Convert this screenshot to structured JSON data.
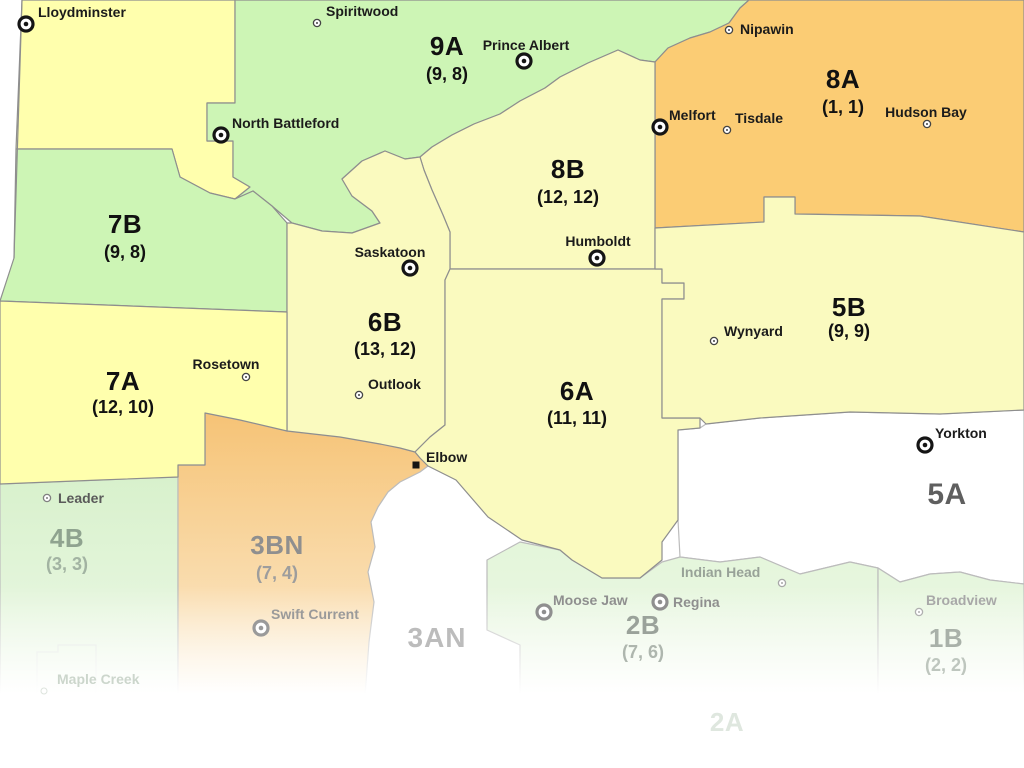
{
  "map": {
    "type": "region-map",
    "province": "Saskatchewan crop districts",
    "colors": {
      "green": "#cdf5b5",
      "yellow": "#ffffad",
      "pale_yellow": "#fafabf",
      "orange": "#fbcc74",
      "white": "#ffffff",
      "border": "#8e8e8e",
      "border_light": "#bcbcbc",
      "maple_outline": "#dbe2db"
    },
    "gradients": {
      "3BN": {
        "from": "#f6c478",
        "to": "#fbe7c6"
      },
      "4B": {
        "from": "#d8f1cc",
        "to": "#ecf8e6"
      },
      "SOUTH": {
        "from": "#e2f5d8",
        "to": "#eef8e8"
      }
    },
    "regions": [
      {
        "id": "9A",
        "label": "9A",
        "value": "(9, 8)",
        "fill": "green",
        "lx": 447,
        "ly": 46,
        "vy": 74,
        "label_color": "#111111",
        "value_color": "#111111"
      },
      {
        "id": "8A",
        "label": "8A",
        "value": "(1, 1)",
        "fill": "orange",
        "lx": 843,
        "ly": 79,
        "vy": 107,
        "label_color": "#111111",
        "value_color": "#111111"
      },
      {
        "id": "8B",
        "label": "8B",
        "value": "(12, 12)",
        "fill": "pale_yellow",
        "lx": 568,
        "ly": 169,
        "vy": 197,
        "label_color": "#111111",
        "value_color": "#111111"
      },
      {
        "id": "7B",
        "label": "7B",
        "value": "(9, 8)",
        "fill": "green",
        "lx": 125,
        "ly": 224,
        "vy": 252,
        "label_color": "#111111",
        "value_color": "#111111"
      },
      {
        "id": "7A",
        "label": "7A",
        "value": "(12, 10)",
        "fill": "yellow",
        "lx": 123,
        "ly": 381,
        "vy": 407,
        "label_color": "#111111",
        "value_color": "#111111"
      },
      {
        "id": "6B",
        "label": "6B",
        "value": "(13, 12)",
        "fill": "pale_yellow",
        "lx": 385,
        "ly": 322,
        "vy": 349,
        "label_color": "#111111",
        "value_color": "#111111"
      },
      {
        "id": "6A",
        "label": "6A",
        "value": "(11, 11)",
        "fill": "pale_yellow",
        "lx": 577,
        "ly": 391,
        "vy": 418,
        "label_color": "#111111",
        "value_color": "#111111"
      },
      {
        "id": "5B",
        "label": "5B",
        "value": "(9, 9)",
        "fill": "pale_yellow",
        "lx": 849,
        "ly": 307,
        "vy": 331,
        "label_color": "#111111",
        "value_color": "#111111"
      },
      {
        "id": "5A",
        "label": "5A",
        "value": null,
        "fill": "white",
        "lx": 947,
        "ly": 495,
        "size": "big",
        "label_color": "#5f5f5f"
      },
      {
        "id": "4B",
        "label": "4B",
        "value": "(3, 3)",
        "fill": "grad:4B",
        "lx": 67,
        "ly": 538,
        "vy": 564,
        "label_color": "#8fa38f",
        "value_color": "#a2b3a2"
      },
      {
        "id": "3BN",
        "label": "3BN",
        "value": "(7, 4)",
        "fill": "grad:3BN",
        "lx": 277,
        "ly": 545,
        "vy": 573,
        "label_color": "#8f8f8f",
        "value_color": "#9d9d9d"
      },
      {
        "id": "3AN",
        "label": "3AN",
        "value": null,
        "fill": null,
        "lx": 437,
        "ly": 638,
        "size": "mid",
        "label_color": "#bcbcbc"
      },
      {
        "id": "2B",
        "label": "2B",
        "value": "(7, 6)",
        "fill": "grad:SOUTH",
        "lx": 643,
        "ly": 625,
        "vy": 652,
        "label_color": "#9aa29a",
        "value_color": "#aeb6ae"
      },
      {
        "id": "1B",
        "label": "1B",
        "value": "(2, 2)",
        "fill": "grad:SOUTH",
        "lx": 946,
        "ly": 638,
        "vy": 665,
        "label_color": "#a9b1a9",
        "value_color": "#bec6be"
      },
      {
        "id": "2A",
        "label": "2A",
        "value": null,
        "fill": null,
        "lx": 727,
        "ly": 722,
        "label_color": "#dfe7df"
      }
    ],
    "cities": [
      {
        "slug": "lloydminster",
        "name": "Lloydminster",
        "marker": "bullseye",
        "x": 26,
        "y": 24,
        "lx": 38,
        "ly": 4,
        "align": "left",
        "label_color": "#1b1b1b",
        "marker_color": "#151515"
      },
      {
        "slug": "spiritwood",
        "name": "Spiritwood",
        "marker": "town",
        "x": 317,
        "y": 23,
        "lx": 326,
        "ly": 3,
        "align": "left",
        "label_color": "#1b1b1b",
        "marker_color": "#444444"
      },
      {
        "slug": "prince-albert",
        "name": "Prince Albert",
        "marker": "bullseye",
        "x": 524,
        "y": 61,
        "lx": 526,
        "ly": 45,
        "align": "center",
        "label_color": "#1b1b1b",
        "marker_color": "#151515"
      },
      {
        "slug": "nipawin",
        "name": "Nipawin",
        "marker": "town",
        "x": 729,
        "y": 30,
        "lx": 740,
        "ly": 21,
        "align": "left",
        "label_color": "#1b1b1b",
        "marker_color": "#444444"
      },
      {
        "slug": "north-battleford",
        "name": "North Battleford",
        "marker": "bullseye",
        "x": 221,
        "y": 135,
        "lx": 232,
        "ly": 115,
        "align": "left",
        "label_color": "#1b1b1b",
        "marker_color": "#151515"
      },
      {
        "slug": "melfort",
        "name": "Melfort",
        "marker": "bullseye",
        "x": 660,
        "y": 127,
        "lx": 669,
        "ly": 107,
        "align": "left",
        "label_color": "#1b1b1b",
        "marker_color": "#151515"
      },
      {
        "slug": "tisdale",
        "name": "Tisdale",
        "marker": "town",
        "x": 727,
        "y": 130,
        "lx": 735,
        "ly": 110,
        "align": "left",
        "label_color": "#1b1b1b",
        "marker_color": "#444444"
      },
      {
        "slug": "hudson-bay",
        "name": "Hudson Bay",
        "marker": "town",
        "x": 927,
        "y": 124,
        "lx": 926,
        "ly": 112,
        "align": "center",
        "label_color": "#1b1b1b",
        "marker_color": "#444444"
      },
      {
        "slug": "saskatoon",
        "name": "Saskatoon",
        "marker": "bullseye",
        "x": 410,
        "y": 268,
        "lx": 390,
        "ly": 252,
        "align": "center",
        "label_color": "#1b1b1b",
        "marker_color": "#151515"
      },
      {
        "slug": "humboldt",
        "name": "Humboldt",
        "marker": "bullseye",
        "x": 597,
        "y": 258,
        "lx": 598,
        "ly": 241,
        "align": "center",
        "label_color": "#1b1b1b",
        "marker_color": "#151515"
      },
      {
        "slug": "wynyard",
        "name": "Wynyard",
        "marker": "town",
        "x": 714,
        "y": 341,
        "lx": 724,
        "ly": 323,
        "align": "left",
        "label_color": "#1b1b1b",
        "marker_color": "#444444"
      },
      {
        "slug": "rosetown",
        "name": "Rosetown",
        "marker": "town",
        "x": 246,
        "y": 377,
        "lx": 226,
        "ly": 364,
        "align": "center",
        "label_color": "#1b1b1b",
        "marker_color": "#444444"
      },
      {
        "slug": "outlook",
        "name": "Outlook",
        "marker": "town",
        "x": 359,
        "y": 395,
        "lx": 368,
        "ly": 376,
        "align": "left",
        "label_color": "#1b1b1b",
        "marker_color": "#444444"
      },
      {
        "slug": "elbow",
        "name": "Elbow",
        "marker": "square",
        "x": 416,
        "y": 465,
        "lx": 426,
        "ly": 449,
        "align": "left",
        "label_color": "#1b1b1b",
        "marker_color": "#151515"
      },
      {
        "slug": "leader",
        "name": "Leader",
        "marker": "town",
        "x": 47,
        "y": 498,
        "lx": 58,
        "ly": 490,
        "align": "left",
        "label_color": "#5a5a5a",
        "marker_color": "#808080"
      },
      {
        "slug": "yorkton",
        "name": "Yorkton",
        "marker": "bullseye",
        "x": 925,
        "y": 445,
        "lx": 935,
        "ly": 425,
        "align": "left",
        "label_color": "#1b1b1b",
        "marker_color": "#151515"
      },
      {
        "slug": "swift-current",
        "name": "Swift Current",
        "marker": "bullseye",
        "x": 261,
        "y": 628,
        "lx": 271,
        "ly": 606,
        "align": "left",
        "label_color": "#9a9a9a",
        "marker_color": "#9a9a9a"
      },
      {
        "slug": "moose-jaw",
        "name": "Moose Jaw",
        "marker": "bullseye",
        "x": 544,
        "y": 612,
        "lx": 553,
        "ly": 592,
        "align": "left",
        "label_color": "#8f8f8f",
        "marker_color": "#8f8f8f"
      },
      {
        "slug": "regina",
        "name": "Regina",
        "marker": "bullseye",
        "x": 660,
        "y": 602,
        "lx": 673,
        "ly": 594,
        "align": "left",
        "label_color": "#8f8f8f",
        "marker_color": "#8f8f8f"
      },
      {
        "slug": "indian-head",
        "name": "Indian Head",
        "marker": "town",
        "x": 782,
        "y": 583,
        "lx": 681,
        "ly": 564,
        "align": "left",
        "label_color": "#98a298",
        "marker_color": "#a8a8a8"
      },
      {
        "slug": "broadview",
        "name": "Broadview",
        "marker": "town",
        "x": 919,
        "y": 612,
        "lx": 926,
        "ly": 592,
        "align": "left",
        "label_color": "#a8a8a8",
        "marker_color": "#b0b0b0"
      },
      {
        "slug": "maple-creek",
        "name": "Maple Creek",
        "marker": "none",
        "x": 44,
        "y": 691,
        "lx": 57,
        "ly": 671,
        "align": "left",
        "label_color": "#ccd6cc",
        "marker_color": "#dde4dd"
      }
    ]
  }
}
